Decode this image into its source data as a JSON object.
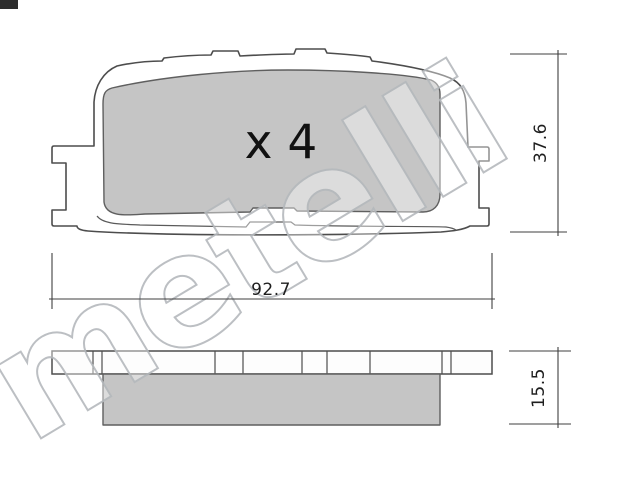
{
  "diagram": {
    "title": "brake pad technical drawing",
    "quantity_label": "x 4",
    "watermark_text": "metelli",
    "dimensions": {
      "pad_height": "37.6",
      "pad_width": "92.7",
      "pad_thickness": "15.5"
    },
    "colors": {
      "outline": "#4d4d4d",
      "pad_fill": "#c5c5c5",
      "background": "#ffffff",
      "dimension_line": "#3f3f3f",
      "watermark_stroke": "#b5b9bd",
      "label_text": "#1e1e1e"
    }
  }
}
